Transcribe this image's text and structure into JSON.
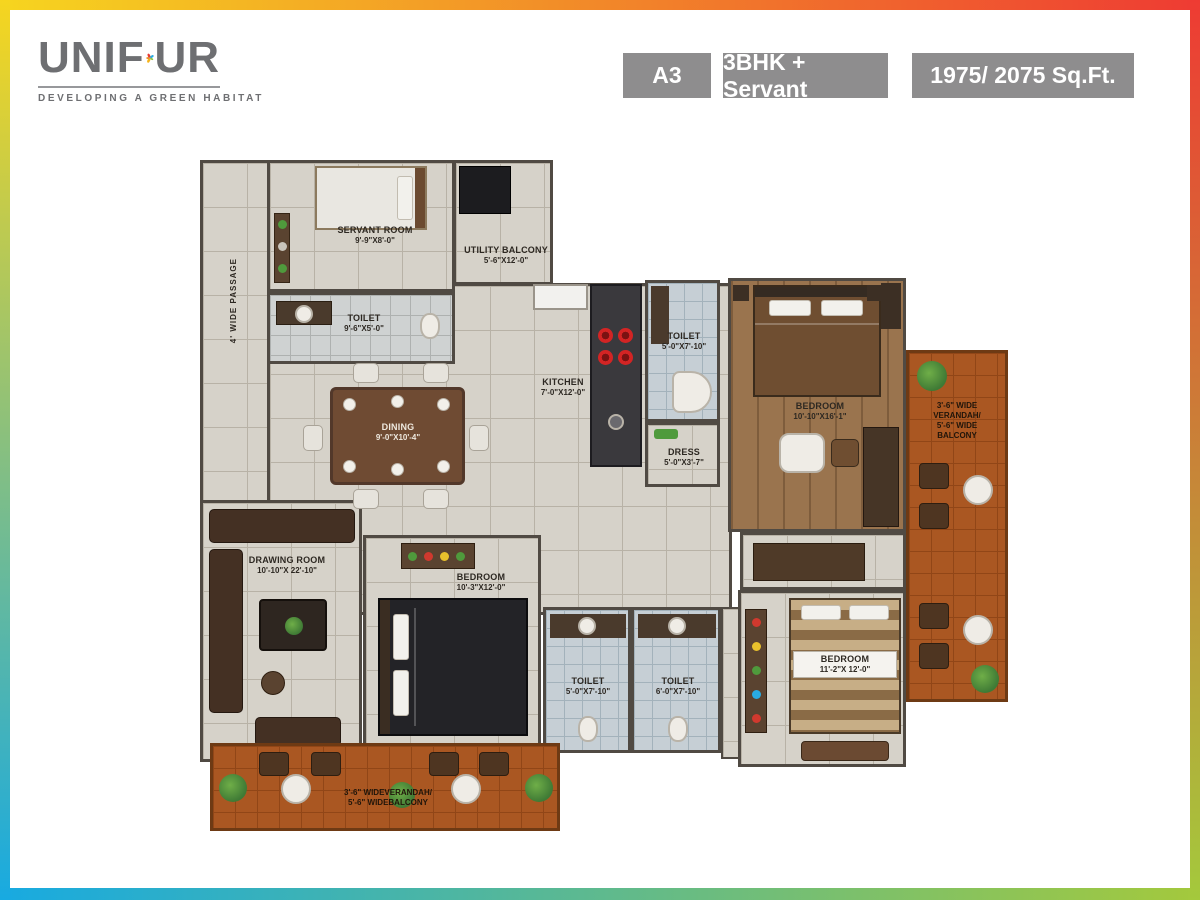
{
  "header": {
    "logo": {
      "part1": "UNIF",
      "part2": "UR",
      "tagline": "DEVELOPING A GREEN HABITAT"
    },
    "badges": [
      {
        "label": "A3"
      },
      {
        "label": "3BHK + Servant"
      },
      {
        "label": "1975/ 2075 Sq.Ft."
      }
    ]
  },
  "plan": {
    "passage_label": "4' WIDE PASSAGE",
    "rooms": {
      "servant": {
        "name": "SERVANT ROOM",
        "dims": "9'-9\"X8'-0\""
      },
      "servant_toilet": {
        "name": "TOILET",
        "dims": "9'-6\"X5'-0\""
      },
      "utility": {
        "name": "UTILITY BALCONY",
        "dims": "5'-6\"X12'-0\""
      },
      "kitchen": {
        "name": "KITCHEN",
        "dims": "7'-0\"X12'-0\""
      },
      "toilet_top": {
        "name": "TOILET",
        "dims": "5'-0\"X7'-10\""
      },
      "dress": {
        "name": "DRESS",
        "dims": "5'-0\"X3'-7\""
      },
      "bedroom_master": {
        "name": "BEDROOM",
        "dims": "10'-10\"X16'-1\""
      },
      "dining": {
        "name": "DINING",
        "dims": "9'-0\"X10'-4\""
      },
      "drawing": {
        "name": "DRAWING ROOM",
        "dims": "10'-10\"X 22'-10\""
      },
      "bedroom_mid": {
        "name": "BEDROOM",
        "dims": "10'-3\"X12'-0\""
      },
      "toilet_left": {
        "name": "TOILET",
        "dims": "5'-0\"X7'-10\""
      },
      "toilet_right": {
        "name": "TOILET",
        "dims": "6'-0\"X7'-10\""
      },
      "bedroom_bottom": {
        "name": "BEDROOM",
        "dims": "11'-2\"X 12'-0\""
      }
    },
    "verandah_right": {
      "l1": "3'-6\" WIDE",
      "l2": "VERANDAH/",
      "l3": "5'-6\" WIDE",
      "l4": "BALCONY"
    },
    "verandah_bottom": {
      "l1": "3'-6\" WIDEVERANDAH/",
      "l2": "5'-6\" WIDEBALCONY"
    }
  },
  "colors": {
    "accent_yellow": "#f6d51f",
    "accent_red": "#ee3b33",
    "accent_blue": "#18aae1",
    "accent_green": "#a4c93c",
    "badge_gray": "#8e8d8e",
    "logo_gray": "#6e6f72",
    "terracotta": "#aa5722"
  }
}
